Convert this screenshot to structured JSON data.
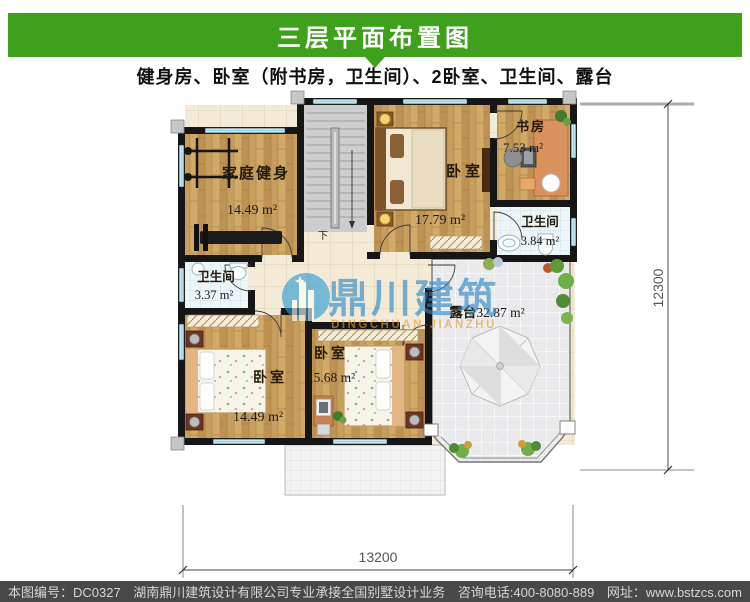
{
  "header": {
    "title": "三层平面布置图",
    "subtitle": "健身房、卧室（附书房，卫生间）、2卧室、卫生间、露台"
  },
  "plan": {
    "rooms": [
      {
        "name": "家庭健身",
        "area": "14.49 m²"
      },
      {
        "name": "卧室",
        "area": "17.79 m²"
      },
      {
        "name": "书房",
        "area": "7.53 m²"
      },
      {
        "name": "卫生间",
        "area": "3.84 m²"
      },
      {
        "name": "卫生间",
        "area": "3.37 m²"
      },
      {
        "name": "卧室",
        "area": "14.49 m²"
      },
      {
        "name": "卧室",
        "area": "15.68 m²"
      },
      {
        "name": "露台",
        "area": "32.87 m²"
      }
    ],
    "stairs_down_label": "下",
    "dimensions": {
      "bottom": "13200",
      "right": "12300"
    }
  },
  "watermark": {
    "cn": "鼎川建筑",
    "en": "DINGCHUAN JIANZHU"
  },
  "footer": {
    "sheet_no": "本图编号：DC0327",
    "company": "湖南鼎川建筑设计有限公司专业承接全国别墅设计业务",
    "phone": "咨询电话:400-8080-889",
    "website": "网址：www.bstzcs.com"
  },
  "colors": {
    "accent_green": "#3fa01e",
    "footer_bg": "#484848",
    "wall": "#161616",
    "window": "#c7ecf6"
  }
}
